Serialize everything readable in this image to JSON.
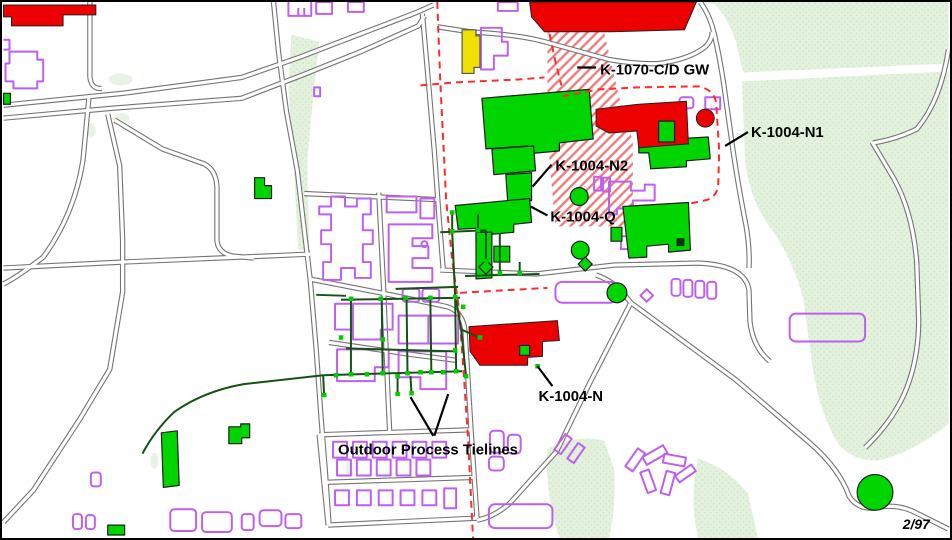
{
  "map": {
    "labels": {
      "k1070": "K-1070-C/D GW",
      "k1004n1": "K-1004-N1",
      "k1004n2": "K-1004-N2",
      "k1004q": "K-1004-Q",
      "k1004n": "K-1004-N",
      "tielines": "Outdoor Process Tielines",
      "date": "2/97"
    },
    "colors": {
      "building-green": "#00D500",
      "building-red": "#EC0000",
      "building-yellow": "#F0E000",
      "outline-purple": "#BE5FF2",
      "road-gray": "#747474",
      "forest-green": "#E4F1DE",
      "forest-dot": "#CBE7C2",
      "boundary-red": "#FF2A2A",
      "hatch-red": "#EE7A7A",
      "tieline-green": "#145214",
      "node-green": "#00CC00"
    }
  }
}
